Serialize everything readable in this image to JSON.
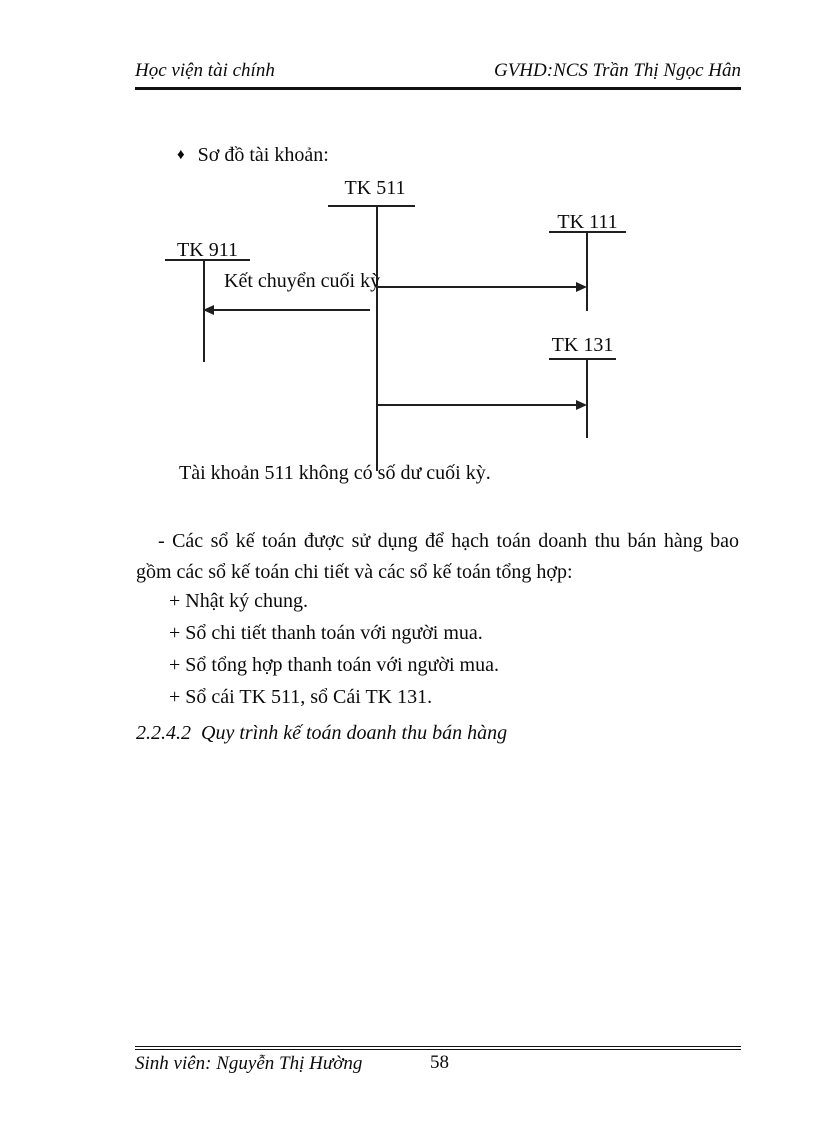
{
  "page": {
    "header": {
      "left": "Học viện tài chính",
      "right": "GVHD:NCS Trần Thị Ngọc Hân"
    },
    "bullet": {
      "glyph": "♦",
      "text": "Sơ đồ tài khoản:"
    },
    "diagram": {
      "accounts": [
        {
          "id": "tk511",
          "label": "TK 511"
        },
        {
          "id": "tk111",
          "label": "TK 111"
        },
        {
          "id": "tk911",
          "label": "TK 911"
        },
        {
          "id": "tk131",
          "label": "TK 131"
        }
      ],
      "arrow_label": "Kết chuyển cuối kỳ",
      "note": "Tài khoản 511 không có số dư cuối kỳ."
    },
    "paragraph": "-  Các sổ kế toán được sử dụng để hạch toán doanh thu bán hàng bao gồm các sổ kế toán chi tiết và các sổ kế toán tổng hợp:",
    "list": [
      "+ Nhật ký chung.",
      "+ Sổ chi tiết thanh toán với người mua.",
      "+ Sổ tổng hợp thanh toán với người mua.",
      "+ Sổ cái TK 511, sổ Cái TK 131."
    ],
    "heading": "2.2.4.2  Quy trình kế toán doanh thu bán hàng",
    "footer": {
      "left": "Sinh viên: Nguyễn Thị Hường",
      "page_number": "58"
    }
  }
}
